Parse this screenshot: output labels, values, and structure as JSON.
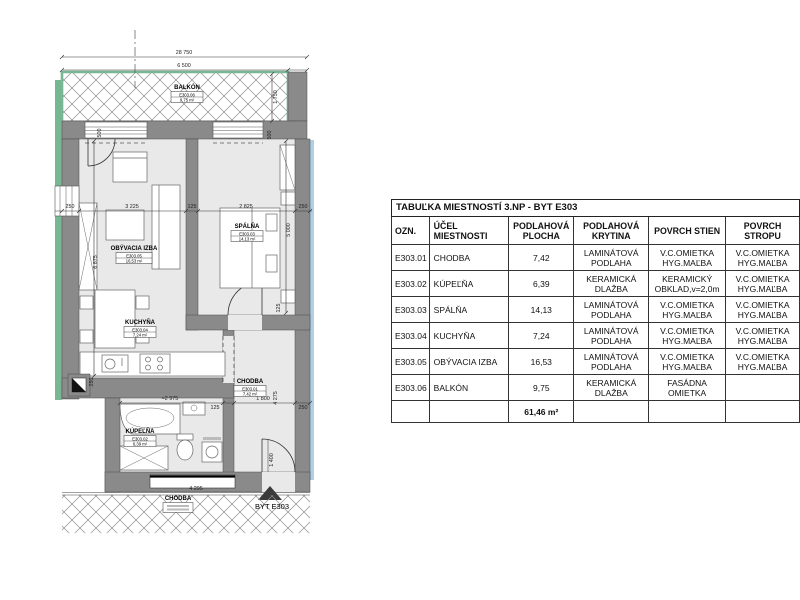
{
  "plan": {
    "apartment_label": "BYT E303",
    "dims": {
      "total_width": "28 750",
      "balcony_width": "6 500",
      "balcony_depth": "1 750",
      "wall_top_left": "500",
      "wall_top_right": "500",
      "m250_left": "250",
      "living_width": "3 225",
      "m125_mid": "125",
      "bedroom_width": "2 825",
      "m250_right": "250",
      "living_depth": "6 875",
      "bedroom_depth": "5 000",
      "m250_kitchen": "250",
      "bath_width": "≈2 975",
      "m125_bottom": "125",
      "hall_width": "1 800",
      "m250_bottom": "250",
      "hall_depth": "4 275",
      "m125_right": "125",
      "entry_width": "1 400",
      "corridor_dim": "4 295"
    },
    "rooms": {
      "balcony": {
        "name": "BALKÓN",
        "code": "E303.06",
        "area": "9,75 m²"
      },
      "living": {
        "name": "OBÝVACIA IZBA",
        "code": "E303.05",
        "area": "16,53 m²"
      },
      "bedroom": {
        "name": "SPÁLŇA",
        "code": "E303.03",
        "area": "14,13 m²"
      },
      "kitchen": {
        "name": "KUCHYŇA",
        "code": "E303.04",
        "area": "7,24 m²"
      },
      "hall": {
        "name": "CHODBA",
        "code": "E303.01",
        "area": "7,42 m²"
      },
      "bath": {
        "name": "KÚPEĽŇA",
        "code": "E303.02",
        "area": "6,39 m²"
      },
      "corridor": {
        "name": "CHODBA"
      }
    }
  },
  "table": {
    "title": "TABUĽKA MIESTNOSTÍ 3.NP - BYT E303",
    "headers": [
      "OZN.",
      "ÚČEL MIESTNOSTI",
      "PODLAHOVÁ PLOCHA",
      "PODLAHOVÁ KRYTINA",
      "POVRCH STIEN",
      "POVRCH STROPU"
    ],
    "rows": [
      [
        "E303.01",
        "CHODBA",
        "7,42",
        "LAMINÁTOVÁ PODLAHA",
        "V.C.OMIETKA HYG.MAĽBA",
        "V.C.OMIETKA HYG.MAĽBA"
      ],
      [
        "E303.02",
        "KÚPEĽŇA",
        "6,39",
        "KERAMICKÁ DLAŽBA",
        "KERAMICKÝ OBKLAD,v=2,0m",
        "V.C.OMIETKA HYG.MAĽBA"
      ],
      [
        "E303.03",
        "SPÁLŇA",
        "14,13",
        "LAMINÁTOVÁ PODLAHA",
        "V.C.OMIETKA HYG.MAĽBA",
        "V.C.OMIETKA HYG.MAĽBA"
      ],
      [
        "E303.04",
        "KUCHYŇA",
        "7,24",
        "LAMINÁTOVÁ PODLAHA",
        "V.C.OMIETKA HYG.MAĽBA",
        "V.C.OMIETKA HYG.MAĽBA"
      ],
      [
        "E303.05",
        "OBÝVACIA IZBA",
        "16,53",
        "LAMINÁTOVÁ PODLAHA",
        "V.C.OMIETKA HYG.MAĽBA",
        "V.C.OMIETKA HYG.MAĽBA"
      ],
      [
        "E303.06",
        "BALKÓN",
        "9,75",
        "KERAMICKÁ DLAŽBA",
        "FASÁDNA OMIETKA",
        ""
      ]
    ],
    "total_area": "61,46 m²"
  },
  "colors": {
    "wall": "#8a8a8a",
    "floor": "#e9e9e9",
    "facade_green": "#79b694",
    "neighbor_blue": "#aecfe4"
  }
}
